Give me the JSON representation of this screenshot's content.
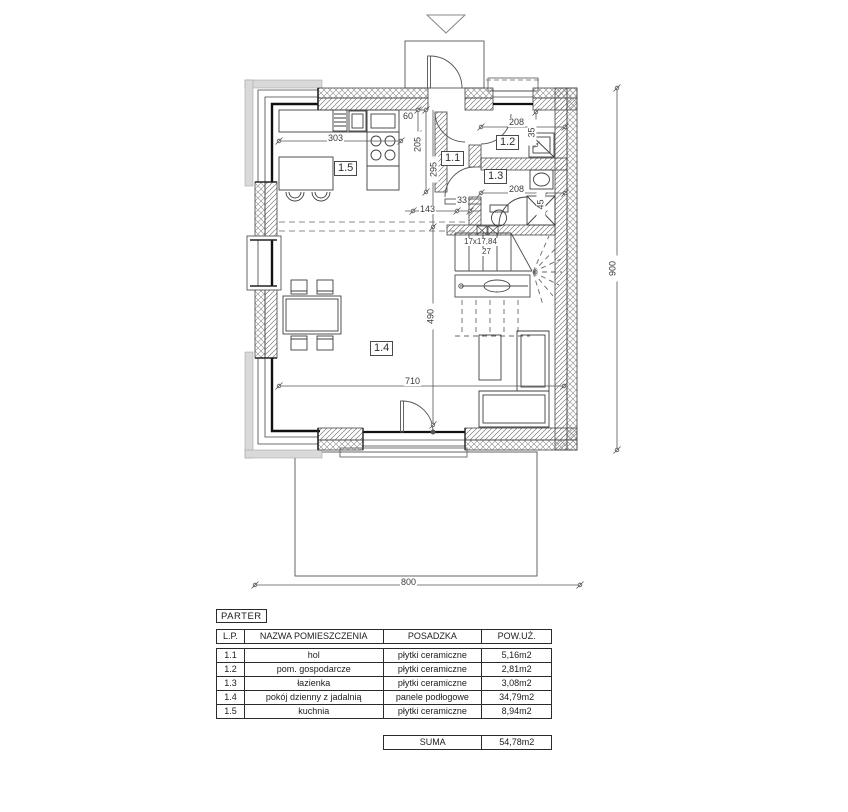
{
  "plan": {
    "room_labels": {
      "r11": "1.1",
      "r12": "1.2",
      "r13": "1.3",
      "r14": "1.4",
      "r15": "1.5"
    },
    "dims": {
      "total_width": "800",
      "total_height": "900",
      "d303": "303",
      "d60": "60",
      "d205": "205",
      "d295": "295",
      "d143": "143",
      "d33": "33",
      "d208a": "208",
      "d35": "35",
      "d208b": "208",
      "d45": "45",
      "d710": "710",
      "d490": "490"
    },
    "stairs": {
      "note": "17x17,84",
      "tread": "27"
    }
  },
  "legend": {
    "title": "PARTER",
    "headers": {
      "lp": "L.P.",
      "name": "NAZWA POMIESZCZENIA",
      "floor": "POSADZKA",
      "area": "POW.UŻ."
    },
    "rows": [
      {
        "lp": "1.1",
        "name": "hol",
        "floor": "płytki ceramiczne",
        "area": "5,16m2"
      },
      {
        "lp": "1.2",
        "name": "pom. gospodarcze",
        "floor": "płytki ceramiczne",
        "area": "2,81m2"
      },
      {
        "lp": "1.3",
        "name": "łazienka",
        "floor": "płytki ceramiczne",
        "area": "3,08m2"
      },
      {
        "lp": "1.4",
        "name": "pokój dzienny z jadalnią",
        "floor": "panele podłogowe",
        "area": "34,79m2"
      },
      {
        "lp": "1.5",
        "name": "kuchnia",
        "floor": "płytki ceramiczne",
        "area": "8,94m2"
      }
    ],
    "summary": {
      "label": "SUMA",
      "value": "54,78m2"
    }
  },
  "colors": {
    "line": "#444444",
    "hatch": "#7a7a7a",
    "dim": "#555555",
    "glass": "#111111"
  }
}
